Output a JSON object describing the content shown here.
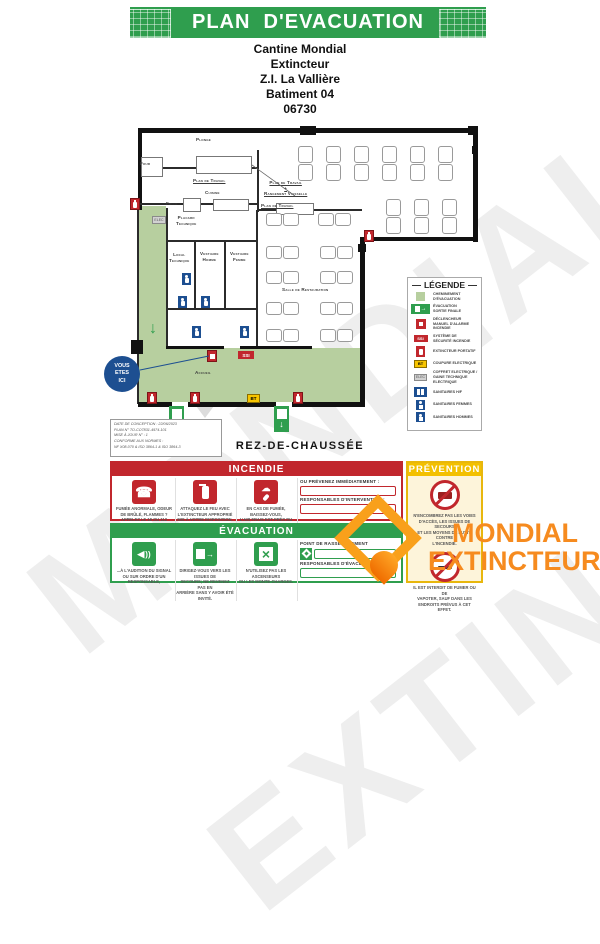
{
  "banner": {
    "title": "PLAN  D'EVACUATION"
  },
  "site": {
    "lines": [
      "Cantine Mondial",
      "Extincteur",
      "Z.I. La Vallière",
      "Batiment 04",
      "06730"
    ]
  },
  "floor": {
    "label": "Rez-de-Chaussée"
  },
  "you_are_here": "VOUS\nETES\nICI",
  "plan": {
    "icon_labels": {
      "ssi": "SSI",
      "bt": "BT",
      "elec": "ELEC",
      "garrow": "↓"
    },
    "walls": [
      [
        138,
        128,
        340,
        5,
        0
      ],
      [
        473,
        128,
        5,
        114,
        0
      ],
      [
        360,
        237,
        118,
        4,
        0
      ],
      [
        360,
        237,
        5,
        170,
        0
      ],
      [
        138,
        128,
        4,
        82,
        0
      ],
      [
        137,
        206,
        2,
        198,
        1
      ],
      [
        138,
        402,
        34,
        5,
        0
      ],
      [
        188,
        402,
        88,
        5,
        0
      ],
      [
        292,
        402,
        73,
        5,
        0
      ],
      [
        257,
        150,
        2,
        62,
        1
      ],
      [
        143,
        167,
        114,
        2,
        1
      ],
      [
        140,
        203,
        118,
        2,
        1
      ],
      [
        166,
        208,
        2,
        140,
        1
      ],
      [
        256,
        210,
        2,
        138,
        1
      ],
      [
        258,
        209,
        104,
        2,
        1
      ],
      [
        166,
        240,
        92,
        2,
        1
      ],
      [
        194,
        240,
        2,
        70,
        1
      ],
      [
        224,
        240,
        2,
        70,
        1
      ],
      [
        166,
        308,
        92,
        2,
        1
      ],
      [
        166,
        346,
        58,
        3,
        0
      ],
      [
        240,
        346,
        72,
        3,
        0
      ],
      [
        300,
        126,
        16,
        9,
        0
      ],
      [
        468,
        126,
        10,
        9,
        0
      ],
      [
        472,
        146,
        6,
        8,
        0
      ],
      [
        358,
        244,
        8,
        8,
        0
      ],
      [
        131,
        340,
        12,
        14,
        0
      ]
    ],
    "boxes": [
      [
        141,
        157,
        20,
        18
      ],
      [
        196,
        156,
        54,
        16
      ],
      [
        183,
        198,
        16,
        12
      ],
      [
        213,
        199,
        34,
        10
      ],
      [
        276,
        203,
        36,
        10
      ]
    ],
    "rooms": [
      {
        "label": "Plonge",
        "x": 196,
        "y": 137
      },
      {
        "label": "Four",
        "x": 140,
        "y": 161
      },
      {
        "label": "Plan de Travail",
        "x": 193,
        "y": 178,
        "u": 1
      },
      {
        "label": "Cuisine",
        "x": 205,
        "y": 190
      },
      {
        "label": "Frigo",
        "x": 166,
        "y": 201
      },
      {
        "label": "Placard\nTechnique",
        "x": 176,
        "y": 215
      },
      {
        "label": "Local\nTechnique",
        "x": 169,
        "y": 252
      },
      {
        "label": "Vestiaire\nHomme",
        "x": 200,
        "y": 251
      },
      {
        "label": "Vestiaire\nFemme",
        "x": 230,
        "y": 251
      },
      {
        "label": "Plan de Travail\n+\nRangement Vaisselle",
        "x": 264,
        "y": 180,
        "u": 1
      },
      {
        "label": "Plan de Travail",
        "x": 261,
        "y": 203,
        "u": 1
      },
      {
        "label": "Salle de Restauration",
        "x": 282,
        "y": 287
      },
      {
        "label": "Accueil",
        "x": 195,
        "y": 370
      }
    ],
    "tables_vertical": [
      {
        "x": 298,
        "y": 146
      },
      {
        "x": 326,
        "y": 146
      },
      {
        "x": 354,
        "y": 146
      },
      {
        "x": 382,
        "y": 146
      },
      {
        "x": 410,
        "y": 146
      },
      {
        "x": 438,
        "y": 146
      },
      {
        "x": 386,
        "y": 199
      },
      {
        "x": 414,
        "y": 199
      },
      {
        "x": 442,
        "y": 199
      }
    ],
    "tables_pair": [
      {
        "x": 266,
        "y": 213
      },
      {
        "x": 318,
        "y": 213
      },
      {
        "x": 266,
        "y": 246
      },
      {
        "x": 320,
        "y": 246
      },
      {
        "x": 266,
        "y": 271
      },
      {
        "x": 320,
        "y": 271
      },
      {
        "x": 266,
        "y": 302
      },
      {
        "x": 320,
        "y": 302
      },
      {
        "x": 266,
        "y": 329
      },
      {
        "x": 320,
        "y": 329
      }
    ],
    "icons": [
      {
        "t": "ext",
        "x": 130,
        "y": 198
      },
      {
        "t": "ext",
        "x": 364,
        "y": 230
      },
      {
        "t": "ext",
        "x": 147,
        "y": 392
      },
      {
        "t": "ext",
        "x": 190,
        "y": 392
      },
      {
        "t": "ext",
        "x": 293,
        "y": 392
      },
      {
        "t": "alarm",
        "x": 207,
        "y": 350
      },
      {
        "t": "ssi",
        "x": 238,
        "y": 351
      },
      {
        "t": "bt",
        "x": 247,
        "y": 394
      },
      {
        "t": "elec",
        "x": 152,
        "y": 216
      },
      {
        "t": "wc",
        "x": 182,
        "y": 273
      },
      {
        "t": "wc",
        "x": 178,
        "y": 296
      },
      {
        "t": "wc",
        "x": 201,
        "y": 296
      },
      {
        "t": "wc",
        "x": 192,
        "y": 326
      },
      {
        "t": "wc",
        "x": 240,
        "y": 326
      },
      {
        "t": "exitdoor",
        "x": 169,
        "y": 406
      },
      {
        "t": "exitdoor",
        "x": 274,
        "y": 406
      },
      {
        "t": "garrow",
        "x": 149,
        "y": 320
      }
    ],
    "info_box": {
      "lines": [
        "DATE DE CONCEPTION : 22/06/2023",
        "PLAN N° TO-CO7831-4974-101",
        "MISE À JOUR N° : 1",
        "CONFORME AUX NORMES :",
        "NF X08-070 & ISO 3864-1 & ISO 3864-3"
      ]
    }
  },
  "legend": {
    "title": "LÉGENDE",
    "items": [
      {
        "icon": "path",
        "label": "CHEMINEMENT\nD'ÉVACUATION"
      },
      {
        "icon": "exith",
        "label": "ÉVACUATION\nSORTIE FINALE"
      },
      {
        "icon": "alarm",
        "label": "DÉCLENCHEUR\nMANUEL D'ALARME\nINCENDIE"
      },
      {
        "icon": "ssi",
        "label": "SYSTÈME DE\nSÉCURITÉ INCENDIE"
      },
      {
        "icon": "ext",
        "label": "EXTINCTEUR PORTATIF"
      },
      {
        "icon": "bt",
        "label": "COUPURE ELECTRIQUE"
      },
      {
        "icon": "elec",
        "label": "COFFRET ELECTRIQUE /\nGAINE TECHNIQUE\nELECTRIQUE"
      },
      {
        "icon": "wchf",
        "label": "SANITAIRES H/F"
      },
      {
        "icon": "wcf",
        "label": "SANITAIRES FEMMES"
      },
      {
        "icon": "wch",
        "label": "SANITAIRES HOMMES"
      }
    ]
  },
  "incendie": {
    "title": "INCENDIE",
    "items": [
      {
        "icon": "phone",
        "text": "FUMÉE ANORMALE, ODEUR\nDE BRÛLÉ, FLAMMES ?\nAPPELEZ LE 18 OU 112"
      },
      {
        "icon": "extb",
        "text": "ATTAQUEZ LE FEU AVEC\nL'EXTINCTEUR APPROPRIÉ\nMIS À VOTRE DISPOSITION."
      },
      {
        "icon": "smoke",
        "text": "EN CAS DE FUMÉE, BAISSEZ-VOUS,\nL'AIR FRAIS EST PRÈS DU SOL."
      }
    ],
    "fields": [
      {
        "label": "OU PRÉVENEZ IMMÉDIATEMENT :"
      },
      {
        "label": "RESPONSABLES D'INTERVENTION :"
      }
    ]
  },
  "evacuation": {
    "title": "ÉVACUATION",
    "items": [
      {
        "icon": "sound",
        "text": "...À L'AUDITION DU SIGNAL\nOU SUR ORDRE D'UN\nRESPONSABLE,"
      },
      {
        "icon": "exit",
        "text": "DIRIGEZ-VOUS VERS LES ISSUES DE\nSECOURS; NE REVENEZ PAS EN\nARRIÈRE SANS Y AVOIR ÉTÉ INVITÉ."
      },
      {
        "icon": "noelev",
        "text": "N'UTILISEZ PAS LES ASCENSEURS\nOU LES MONTE-CHARGES."
      }
    ],
    "fields": [
      {
        "label": "POINT DE RASSEMBLEMENT",
        "has_icon": true
      },
      {
        "label": "RESPONSABLES D'ÉVACUATION :"
      }
    ]
  },
  "prevention": {
    "title": "PRÉVENTION",
    "items": [
      {
        "icon": "notruck",
        "text": "N'ENCOMBREZ PAS LES VOIES\nD'ACCÈS, LES ISSUES DE SECOURS\nET LES MOYENS DE LUTTE CONTRE\nL'INCENDIE."
      },
      {
        "icon": "nosmoke",
        "text": "IL EST INTERDIT DE FUMER OU DE\nVAPOTER, SAUF DANS LES\nENDROITS PRÉVUS À CET EFFET."
      }
    ]
  },
  "brand": {
    "line1": "MONDIAL",
    "line2": "EXTINCTEUR"
  },
  "colors": {
    "green": "#2f9e4e",
    "red": "#c1272d",
    "yellow": "#f3c000",
    "blue": "#1d4f91",
    "path_green": "#b7cf9f",
    "orange": "#f68b1f"
  }
}
